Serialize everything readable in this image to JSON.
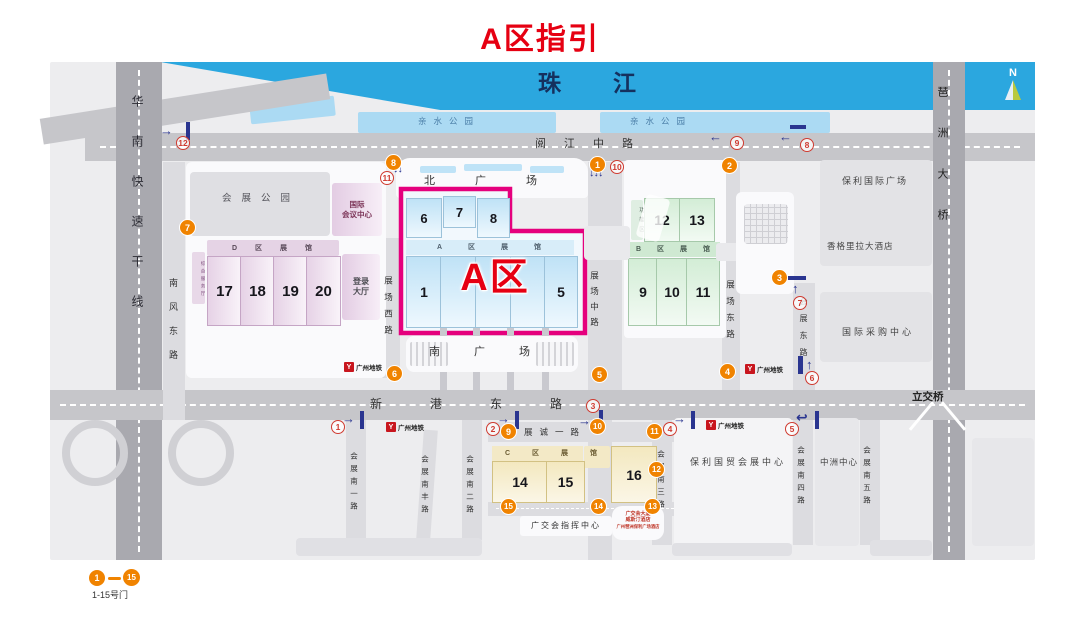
{
  "title": "A区指引",
  "compass": {
    "label": "N"
  },
  "river": {
    "name": "珠江"
  },
  "parks": {
    "label": "亲水公园"
  },
  "roads": {
    "yuejiang_zhong": "阅江中路",
    "xingang_dong": "新港东路",
    "huanan_kuaisu": "华南快速干线",
    "pazhou_daqiao": "琶洲大桥",
    "nanfeng_dong": "南风东路",
    "zhanchang_xi": "展场西路",
    "zhanchang_zhong": "展场中路",
    "zhanchang_dong": "展场东路",
    "huizhan_dong": "会展东路",
    "zhancheng_yi": "展诚一路",
    "huizhan_nan_yi": "会展南一路",
    "huizhan_nanfeng": "会展南丰路",
    "huizhan_nan_er": "会展南二路",
    "huizhan_nan_san": "会展南三路",
    "huizhan_nan_si": "会展南四路",
    "huizhan_nan_wu": "会展南五路",
    "lijiaoqiao": "立交桥"
  },
  "squares": {
    "north": "北广场",
    "south": "南广场"
  },
  "zones": {
    "a_label": "A区",
    "a_header": "A区展馆",
    "b_header": "B区展馆",
    "c_header": "C区展馆",
    "d_header": "D区展馆",
    "function_zone": "功能区",
    "service_hall": "综合服务厅"
  },
  "halls": {
    "h1": "1",
    "h5": "5",
    "h6": "6",
    "h7": "7",
    "h8": "8",
    "h9": "9",
    "h10": "10",
    "h11": "11",
    "h12": "12",
    "h13": "13",
    "h14": "14",
    "h15": "15",
    "h16": "16",
    "h17": "17",
    "h18": "18",
    "h19": "19",
    "h20": "20"
  },
  "buildings": {
    "exhibition_park": "会展公园",
    "convention_line1": "国际",
    "convention_line2": "会议中心",
    "login_line1": "登录",
    "login_line2": "大厅",
    "poly_plaza": "保利国际广场",
    "shangri_la": "香格里拉大酒店",
    "sourcing_center": "国际采购中心",
    "poly_trade_center": "保利国贸会展中心",
    "zhongzhou_center": "中洲中心",
    "command_center": "广交会指挥中心",
    "note_line1": "广交会大厦",
    "note_line2": "威斯汀酒店",
    "note_line3": "广州琶洲保利广场酒店"
  },
  "metro": {
    "label": "广州地铁",
    "mark": "Y"
  },
  "legend": {
    "first": "1",
    "last": "15",
    "caption": "1-15号门"
  },
  "gates": [
    "1",
    "2",
    "3",
    "4",
    "5",
    "6",
    "7",
    "8",
    "9",
    "10",
    "11",
    "12",
    "13",
    "14",
    "15"
  ],
  "routes": [
    {
      "n": "1",
      "arrow": "→"
    },
    {
      "n": "2",
      "arrow": "→"
    },
    {
      "n": "3",
      "arrow": "→"
    },
    {
      "n": "4",
      "arrow": "→"
    },
    {
      "n": "5",
      "arrow": "↩"
    },
    {
      "n": "6",
      "arrow": "↑"
    },
    {
      "n": "7",
      "arrow": "↑"
    },
    {
      "n": "8",
      "arrow": "←"
    },
    {
      "n": "9",
      "arrow": "←"
    },
    {
      "n": "10",
      "arrow": "↓↓↓"
    },
    {
      "n": "11",
      "arrow": "↓↓"
    },
    {
      "n": "12",
      "arrow": "→"
    }
  ]
}
